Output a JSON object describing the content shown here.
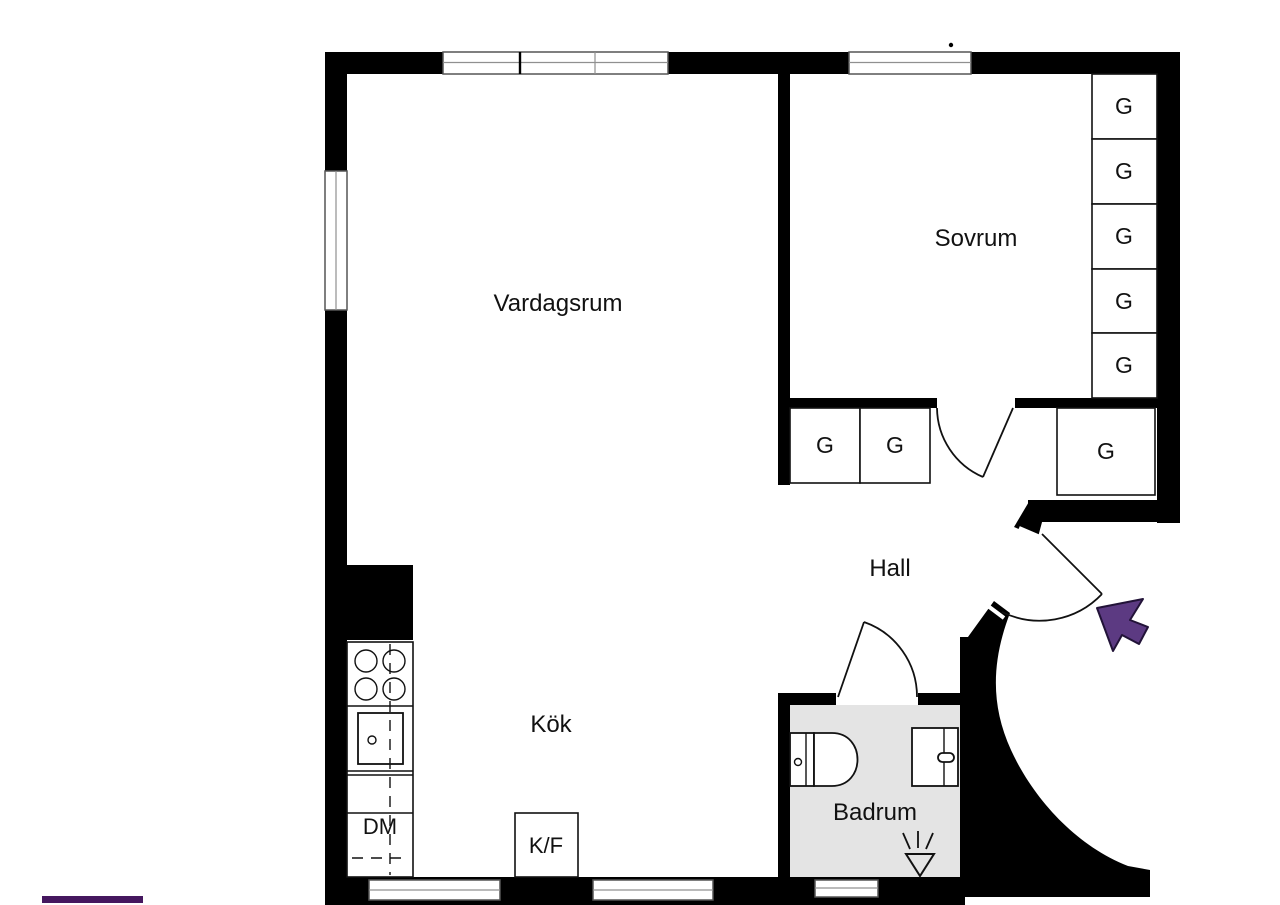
{
  "labels": {
    "living_room": "Vardagsrum",
    "bedroom": "Sovrum",
    "hall": "Hall",
    "kitchen": "Kök",
    "bathroom": "Badrum",
    "wardrobe": "G",
    "dishwasher": "DM",
    "fridge_freezer": "K/F"
  },
  "colors": {
    "wall": "#000000",
    "bath-floor": "#e4e4e4",
    "line": "#111111",
    "frame": "#555555",
    "mullion": "#909090",
    "arrow-fill": "#5c3a82",
    "arrow-stroke": "#221338",
    "brand-bar": "#45175f"
  }
}
